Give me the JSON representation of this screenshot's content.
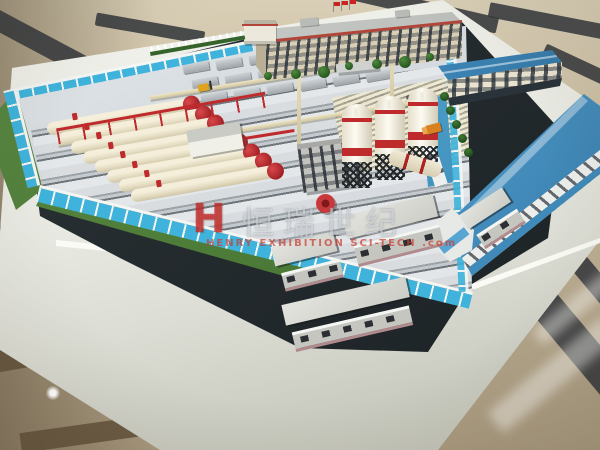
{
  "scene": {
    "type": "photograph",
    "subject": "Architectural scale model of an industrial plant displayed on a white table over a marble floor",
    "watermark": {
      "logo_letter": "H",
      "cjk_text": "恒瑞世纪",
      "latin_text": "HENRY EXHIBITION SCI-TECH .com"
    },
    "colors": {
      "floor_beige": "#c3b69a",
      "floor_dark_band": "#35393c",
      "floor_brown_band": "#62503a",
      "table_white": "#e9eae3",
      "mat_dark": "#242b2e",
      "yard_floor": "#ccd3d9",
      "wall_glass_blue": "#3fb3dc",
      "wall_frame_white": "#f4f6f4",
      "accent_red": "#bf2a2c",
      "cream": "#e9e2cb",
      "roof_blue": "#3c85b6",
      "roof_blue_light": "#8cc8ea",
      "building_tan": "#d8cfb6",
      "window_dark": "#333b43",
      "lawn_green": "#4a7c38",
      "tree_green": "#2d5c2a",
      "machine_yellow": "#e0a31f",
      "machine_orange": "#d8821f",
      "silo_white": "#f2eee2",
      "steel_dark": "#23272a",
      "aux_base_pink": "#b08b8d"
    },
    "counts": {
      "tanks": 8,
      "silos": 3,
      "slab_rows": 3,
      "slab_cols": 6,
      "office_floors": 4,
      "front_trees": 7,
      "palm_trees": 5,
      "pump_stations": 5,
      "forklifts": 2,
      "flags": 3,
      "aux_buildings": 4
    }
  }
}
